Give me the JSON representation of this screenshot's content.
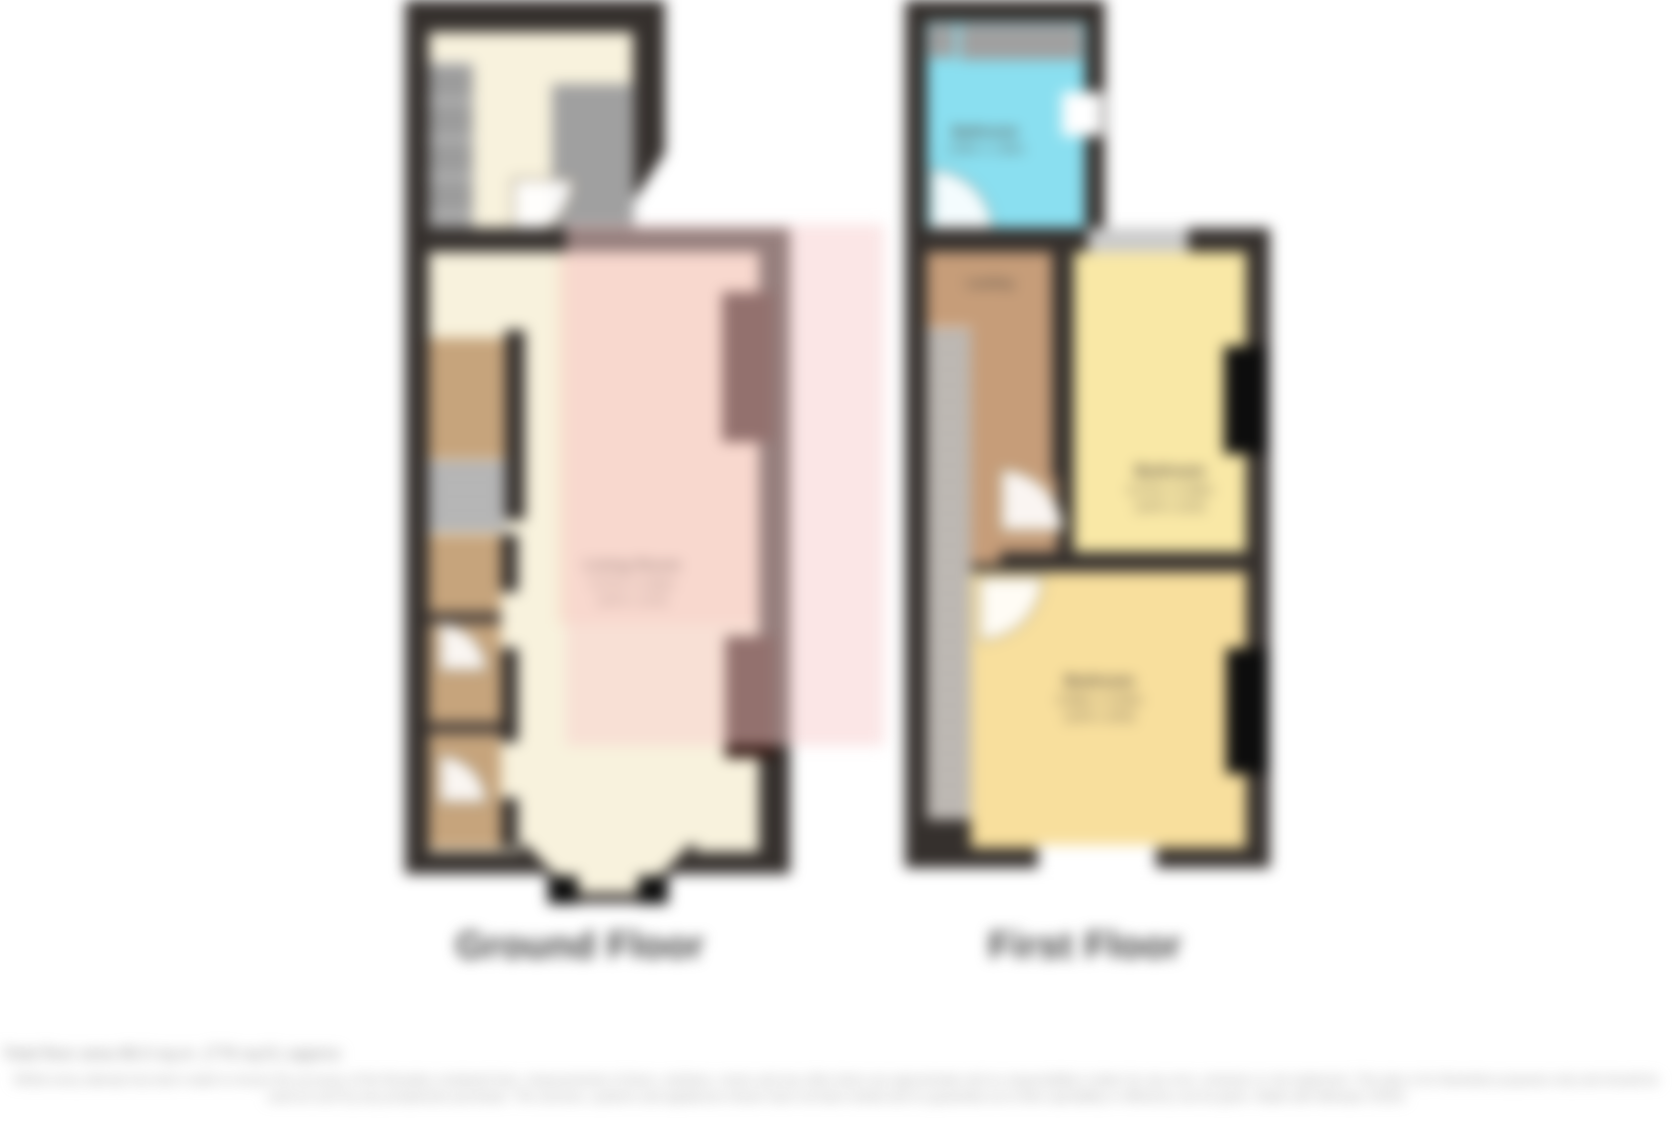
{
  "floors": {
    "ground": {
      "label": "Ground Floor",
      "rooms": {
        "living_room": {
          "name": "Living Room",
          "dims_metric": "4.57m x 3.66m",
          "dims_imperial": "(15'0 x 12'0)"
        }
      }
    },
    "first": {
      "label": "First Floor",
      "rooms": {
        "bathroom": {
          "name": "Bathroom",
          "dims_metric": "1.90m x 1.85m"
        },
        "landing": {
          "name": "Landing"
        },
        "bedroom1": {
          "name": "Bedroom",
          "dims_metric": "4.27m x 3.35m",
          "dims_imperial": "(14'0 x 11'0)"
        },
        "bedroom2": {
          "name": "Bedroom",
          "dims_metric": "3.96m x 3.05m",
          "dims_imperial": "(13'0 x 10'0)"
        }
      }
    }
  },
  "footer": {
    "total_area": "Total floor area 86.0 sq.m. (776 sq.ft.) approx",
    "disclaimer": "Whilst every attempt has been made to ensure the accuracy of the floorplan contained here, measurements of doors, windows, rooms and any other items are approximate and no responsibility is taken for any error, omission or mis-statement. This plan is for illustrative purposes only and should be used as such by any prospective purchaser. The services, systems and appliances shown have not been tested and no guarantee as to their operability or efficiency can be given. Made with Metropix ©2023"
  },
  "colors": {
    "wall": "#35302d",
    "floor_cream": "#f8f2dd",
    "floor_peach": "#f9e2cf",
    "floor_tan": "#c6a47c",
    "bathroom_cyan": "#8adff0",
    "landing_brown": "#c69d79",
    "bedroom_yellow": "#f9e8a6",
    "bedroom_amber": "#f8df9d",
    "highlight_pink": "rgba(247,205,205,0.5)",
    "recess_dark": "#2e140e",
    "title_gray": "#3d3d3d",
    "footer_gray": "#9c9c9c"
  }
}
